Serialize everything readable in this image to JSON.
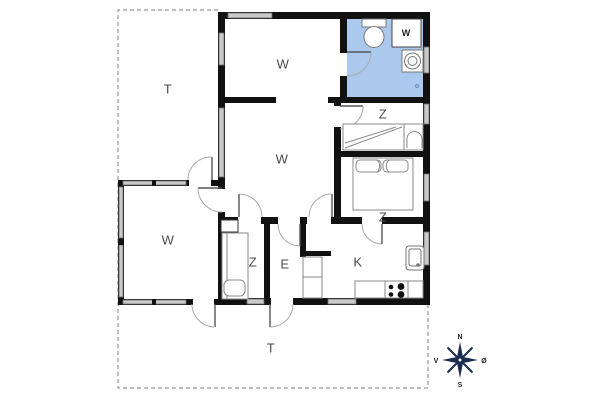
{
  "plan": {
    "rooms": {
      "terrace_left": {
        "label": "T"
      },
      "terrace_bottom": {
        "label": "T"
      },
      "living_top": {
        "label": "W"
      },
      "living_main": {
        "label": "W"
      },
      "conservatory": {
        "label": "W"
      },
      "bedroom_top": {
        "label": "Z"
      },
      "bedroom_middle": {
        "label": "Z"
      },
      "bedroom_small": {
        "label": "Z"
      },
      "entry": {
        "label": "E"
      },
      "kitchen": {
        "label": "K"
      }
    },
    "fixtures": {
      "washing_machine_label": "W"
    },
    "compass": {
      "north": "N",
      "south": "S",
      "west": "V",
      "east": "Ø"
    },
    "colors": {
      "bathroom_fill": "#abc9ec",
      "wall": "#111111",
      "window_fill": "#c9c9c9",
      "label_text": "#4a4a4a",
      "compass": "#1c2b50",
      "dashed_outline": "#9a9a9a"
    }
  }
}
